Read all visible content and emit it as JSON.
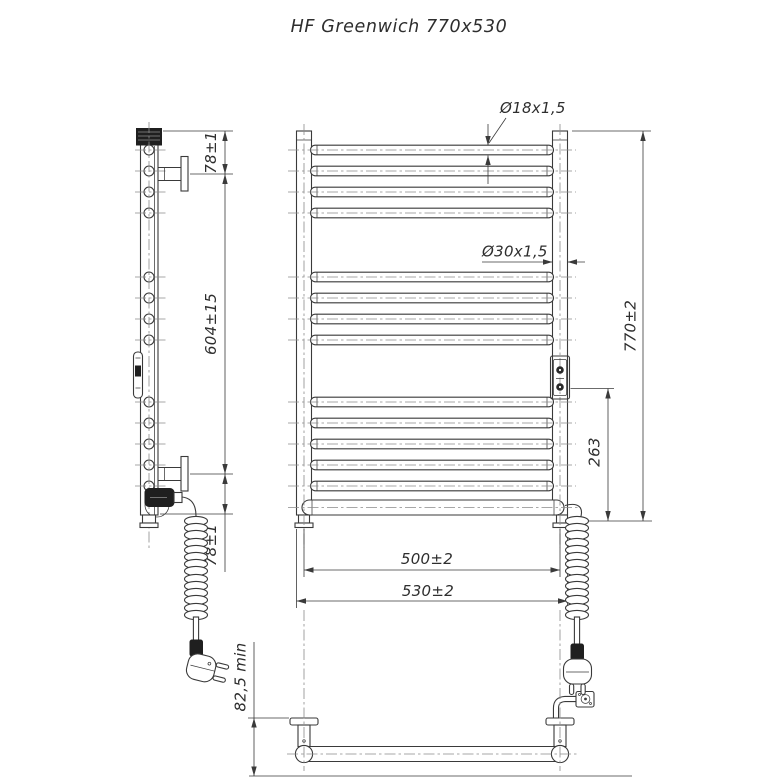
{
  "title": "HF Greenwich 770x530",
  "dimensions": {
    "bracket_top_offset": "78±1",
    "bracket_vertical_span": "604±15",
    "bracket_bottom_offset": "78±1",
    "wall_clearance_min": "82,5 min",
    "rung_tube_size": "Ø18x1,5",
    "stand_tube_size": "Ø30x1,5",
    "overall_height": "770±2",
    "regulator_to_bottom": "263",
    "mounting_centers_width": "500±2",
    "overall_width": "530±2"
  },
  "colors": {
    "line": "#3a3a3a",
    "centerline": "#8a8a8a",
    "background": "#ffffff",
    "solid_fill": "#1f1f1f"
  }
}
